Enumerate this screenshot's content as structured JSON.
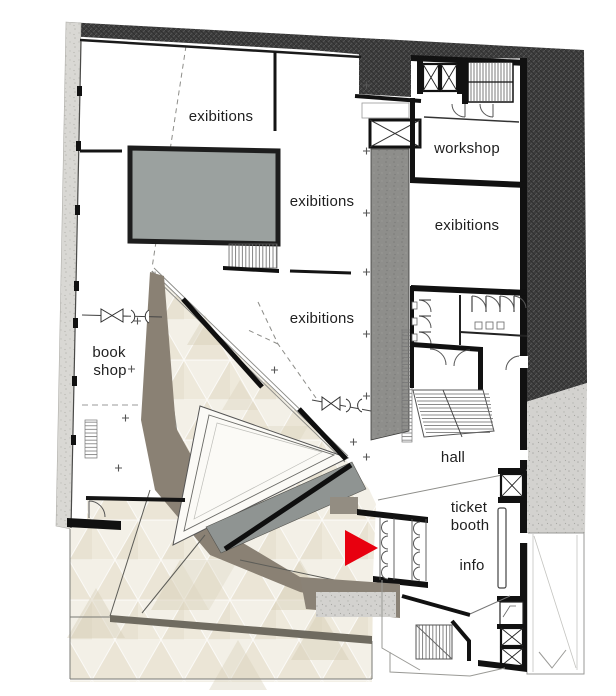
{
  "plan": {
    "rooms": {
      "exhibitions_top": "exibitions",
      "exhibitions_mid": "exibitions",
      "exhibitions_center": "exibitions",
      "exhibitions_right": "exibitions",
      "workshop": "workshop",
      "book_shop": {
        "line1": "book",
        "line2": "shop"
      },
      "hall": "hall",
      "ticket_booth": {
        "line1": "ticket",
        "line2": "booth"
      },
      "info": "info"
    },
    "marker": {
      "kind": "entrance-arrow",
      "color": "#e8000f"
    },
    "colors": {
      "site_hatch": "#3c3c3c",
      "sidewalk_concrete": "#d3d2cf",
      "exterior_wall_concrete": "#d9d8d4",
      "core_wall": "#8e8e8b",
      "wall_black": "#141414",
      "room_void_gray": "#9ba19f",
      "atrium_band": "#8a8174",
      "ramp_gray": "#8f9492",
      "tile_light": "#f2efe6",
      "tile_dark": "#ddd5c1",
      "accent_red": "#e8000f"
    }
  }
}
